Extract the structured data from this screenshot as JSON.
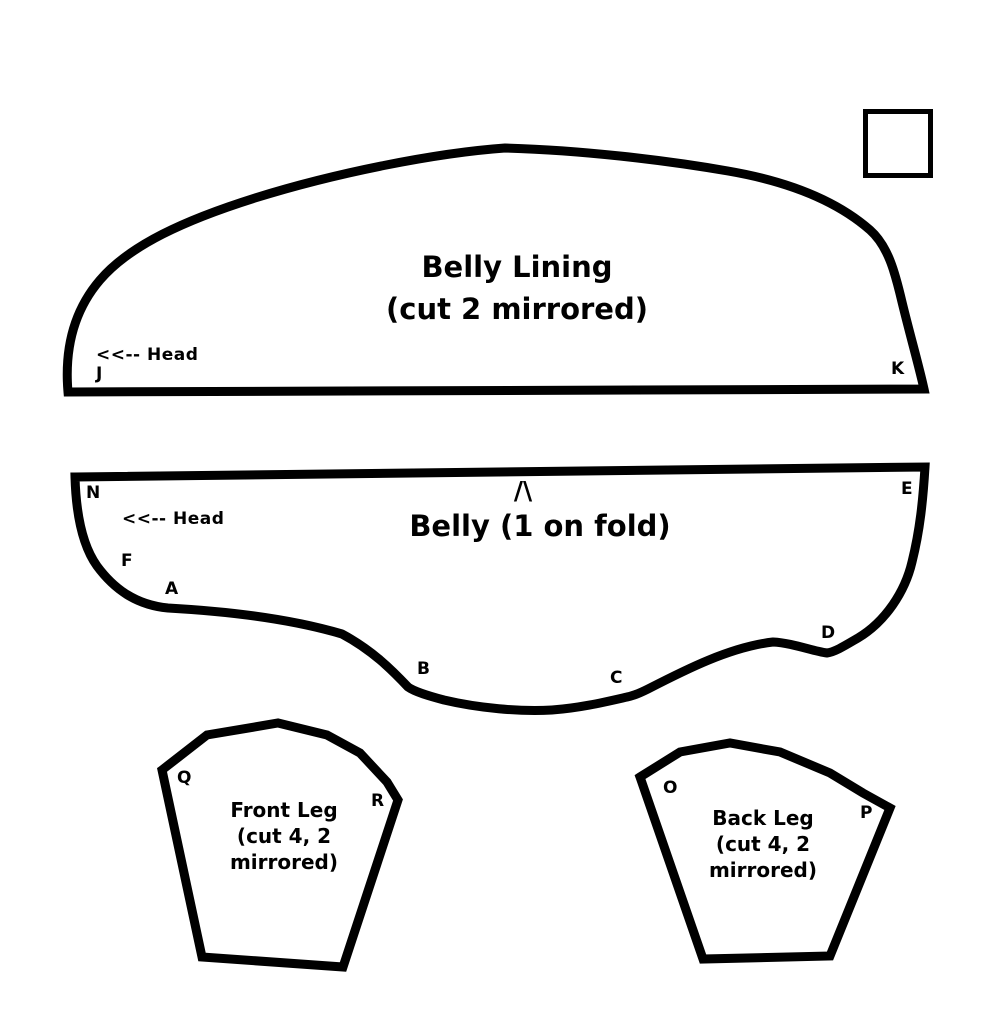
{
  "colors": {
    "ink": "#000000",
    "background": "#ffffff"
  },
  "pieces": {
    "belly_lining": {
      "title_line1": "Belly Lining",
      "title_line2": "(cut 2 mirrored)",
      "head_note": "<<-- Head",
      "point_labels": {
        "J": "J",
        "K": "K"
      }
    },
    "belly": {
      "fold_mark": "/\\",
      "title": "Belly (1 on fold)",
      "head_note": "<<-- Head",
      "point_labels": {
        "N": "N",
        "F": "F",
        "A": "A",
        "B": "B",
        "C": "C",
        "D": "D",
        "E": "E"
      }
    },
    "front_leg": {
      "title_line1": "Front Leg",
      "title_line2": "(cut 4, 2",
      "title_line3": "mirrored)",
      "point_labels": {
        "Q": "Q",
        "R": "R"
      }
    },
    "back_leg": {
      "title_line1": "Back Leg",
      "title_line2": "(cut 4, 2",
      "title_line3": "mirrored)",
      "point_labels": {
        "O": "O",
        "P": "P"
      }
    }
  }
}
